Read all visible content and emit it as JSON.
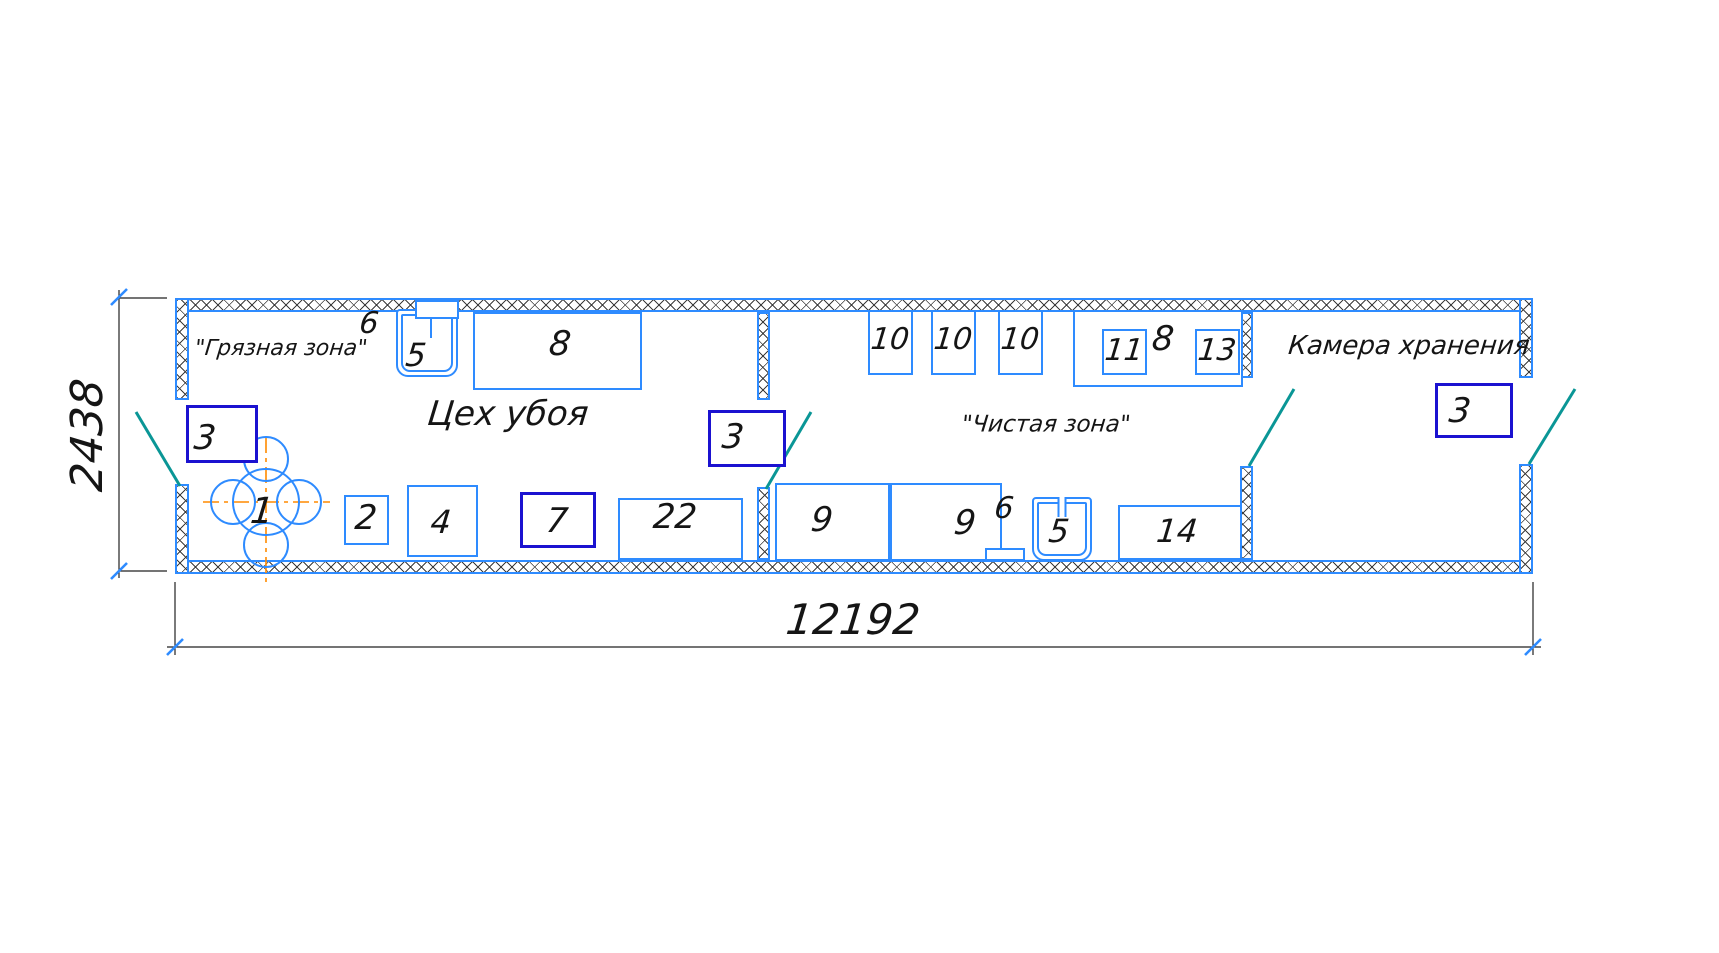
{
  "drawing": {
    "type": "floor-plan",
    "overall_dimensions": {
      "width_mm": "12192",
      "height_mm": "2438"
    },
    "rooms": [
      {
        "name": "Цех убоя",
        "zone_label": "\"Грязная зона\""
      },
      {
        "name": "",
        "zone_label": "\"Чистая зона\""
      },
      {
        "name": "Камера хранения",
        "zone_label": ""
      }
    ],
    "colors": {
      "wall_blue": "#2e8bff",
      "equipment_blue": "#2e8bff",
      "equipment_dark_blue": "#1b12d0",
      "door_teal": "#0a9696",
      "centerline_orange": "#ff8a00",
      "ink": "#151515"
    },
    "walls": [
      {
        "x": 175,
        "y": 298,
        "w": 1358,
        "h": 14,
        "name": "top-outer-wall"
      },
      {
        "x": 175,
        "y": 560,
        "w": 1358,
        "h": 14,
        "name": "bottom-outer-wall"
      },
      {
        "x": 175,
        "y": 298,
        "w": 14,
        "h": 102,
        "name": "left-wall-upper"
      },
      {
        "x": 175,
        "y": 484,
        "w": 14,
        "h": 90,
        "name": "left-wall-lower"
      },
      {
        "x": 1519,
        "y": 298,
        "w": 14,
        "h": 80,
        "name": "right-wall-upper"
      },
      {
        "x": 1519,
        "y": 464,
        "w": 14,
        "h": 110,
        "name": "right-wall-lower"
      },
      {
        "x": 757,
        "y": 312,
        "w": 13,
        "h": 88,
        "name": "partition1-upper"
      },
      {
        "x": 757,
        "y": 487,
        "w": 13,
        "h": 73,
        "name": "partition1-lower"
      },
      {
        "x": 1240,
        "y": 312,
        "w": 13,
        "h": 66,
        "name": "partition2-upper"
      },
      {
        "x": 1240,
        "y": 466,
        "w": 13,
        "h": 94,
        "name": "partition2-lower"
      }
    ],
    "equipment": [
      {
        "label": "3",
        "x": 186,
        "y": 405,
        "w": 72,
        "h": 58,
        "st": "dark"
      },
      {
        "label": "2",
        "x": 344,
        "y": 495,
        "w": 45,
        "h": 50,
        "st": "light"
      },
      {
        "label": "4",
        "x": 407,
        "y": 485,
        "w": 71,
        "h": 72,
        "st": "light"
      },
      {
        "label": "7",
        "x": 520,
        "y": 492,
        "w": 76,
        "h": 56,
        "st": "dark"
      },
      {
        "label": "22",
        "x": 618,
        "y": 498,
        "w": 125,
        "h": 62,
        "st": "light"
      },
      {
        "label": "8",
        "x": 473,
        "y": 312,
        "w": 169,
        "h": 78,
        "st": "light"
      },
      {
        "label": "3",
        "x": 708,
        "y": 410,
        "w": 78,
        "h": 57,
        "st": "dark"
      },
      {
        "label": "10",
        "x": 868,
        "y": 310,
        "w": 45,
        "h": 65,
        "st": "light"
      },
      {
        "label": "10",
        "x": 931,
        "y": 310,
        "w": 45,
        "h": 65,
        "st": "light"
      },
      {
        "label": "10",
        "x": 998,
        "y": 310,
        "w": 45,
        "h": 65,
        "st": "light"
      },
      {
        "label": "8",
        "x": 1073,
        "y": 310,
        "w": 170,
        "h": 77,
        "st": "light"
      },
      {
        "label": "11",
        "x": 1102,
        "y": 329,
        "w": 45,
        "h": 46,
        "st": "light"
      },
      {
        "label": "13",
        "x": 1195,
        "y": 329,
        "w": 45,
        "h": 46,
        "st": "light"
      },
      {
        "label": "9",
        "x": 775,
        "y": 483,
        "w": 115,
        "h": 78,
        "st": "light"
      },
      {
        "label": "9",
        "x": 890,
        "y": 483,
        "w": 112,
        "h": 78,
        "st": "light"
      },
      {
        "label": "",
        "x": 985,
        "y": 548,
        "w": 40,
        "h": 13,
        "st": "light"
      },
      {
        "label": "14",
        "x": 1118,
        "y": 505,
        "w": 124,
        "h": 55,
        "st": "light"
      },
      {
        "label": "3",
        "x": 1435,
        "y": 383,
        "w": 78,
        "h": 55,
        "st": "dark"
      }
    ],
    "sinks": [
      {
        "x": 396,
        "y": 309,
        "w": 62,
        "h": 68,
        "heater": {
          "x": 415,
          "y": 300,
          "w": 44,
          "h": 19
        },
        "pipe": {
          "x": 430,
          "y": 318,
          "h": 20
        }
      },
      {
        "x": 1032,
        "y": 497,
        "w": 60,
        "h": 64,
        "slot": true
      }
    ],
    "scalder_circles": {
      "circles": [
        [
          266,
          502,
          33
        ],
        [
          266,
          459,
          22
        ],
        [
          266,
          545,
          22
        ],
        [
          233,
          502,
          22
        ],
        [
          299,
          502,
          22
        ]
      ],
      "centerlines": [
        [
          266,
          437,
          266,
          585
        ],
        [
          203,
          502,
          330,
          502
        ]
      ]
    },
    "equipment4_ellipse": [
      441,
      521,
      29,
      27
    ],
    "doors": [
      [
        136,
        412,
        180,
        486
      ],
      [
        811,
        412,
        766,
        489
      ],
      [
        1294,
        389,
        1249,
        466
      ],
      [
        1575,
        389,
        1529,
        464
      ]
    ],
    "dim_v": {
      "value": "2438",
      "line": [
        119,
        290,
        119,
        578
      ],
      "ext": [
        [
          119,
          298,
          167,
          298
        ],
        [
          119,
          571,
          167,
          571
        ]
      ],
      "ticks": [
        [
          119,
          297
        ],
        [
          119,
          571
        ]
      ]
    },
    "dim_h": {
      "value": "12192",
      "line": [
        167,
        647,
        1541,
        647
      ],
      "ext": [
        [
          175,
          582,
          175,
          655
        ],
        [
          1533,
          582,
          1533,
          655
        ]
      ],
      "ticks": [
        [
          175,
          647
        ],
        [
          1533,
          647
        ]
      ]
    },
    "texts": [
      {
        "s": "6",
        "x": 369,
        "y": 324,
        "fs": 30,
        "name": "equipment-label-6"
      },
      {
        "s": "5",
        "x": 416,
        "y": 355,
        "fs": 32,
        "name": "equipment-label-5"
      },
      {
        "s": "8",
        "x": 560,
        "y": 344,
        "fs": 34,
        "name": "equipment-label-8"
      },
      {
        "s": "\"Грязная зона\"",
        "x": 281,
        "y": 349,
        "fs": 22,
        "name": "zone-label-dirty"
      },
      {
        "s": "Цех убоя",
        "x": 508,
        "y": 414,
        "fs": 34,
        "name": "room-label-slaughter-shop"
      },
      {
        "s": "3",
        "x": 205,
        "y": 438,
        "fs": 34,
        "name": "equipment-label-3"
      },
      {
        "s": "1",
        "x": 262,
        "y": 512,
        "fs": 36,
        "name": "equipment-label-1"
      },
      {
        "s": "2",
        "x": 366,
        "y": 518,
        "fs": 34,
        "name": "equipment-label-2"
      },
      {
        "s": "4",
        "x": 441,
        "y": 522,
        "fs": 32,
        "name": "equipment-label-4"
      },
      {
        "s": "7",
        "x": 557,
        "y": 521,
        "fs": 34,
        "name": "equipment-label-7"
      },
      {
        "s": "22",
        "x": 675,
        "y": 517,
        "fs": 34,
        "name": "equipment-label-22"
      },
      {
        "s": "3",
        "x": 733,
        "y": 437,
        "fs": 34,
        "name": "equipment-label-3"
      },
      {
        "s": "10",
        "x": 890,
        "y": 340,
        "fs": 30,
        "name": "equipment-label-10"
      },
      {
        "s": "10",
        "x": 953,
        "y": 340,
        "fs": 30,
        "name": "equipment-label-10"
      },
      {
        "s": "10",
        "x": 1020,
        "y": 340,
        "fs": 30,
        "name": "equipment-label-10"
      },
      {
        "s": "11",
        "x": 1124,
        "y": 351,
        "fs": 30,
        "name": "equipment-label-11"
      },
      {
        "s": "8",
        "x": 1163,
        "y": 339,
        "fs": 34,
        "name": "equipment-label-8"
      },
      {
        "s": "13",
        "x": 1217,
        "y": 351,
        "fs": 30,
        "name": "equipment-label-13"
      },
      {
        "s": "\"Чистая зона\"",
        "x": 1046,
        "y": 425,
        "fs": 23,
        "name": "zone-label-clean"
      },
      {
        "s": "9",
        "x": 822,
        "y": 520,
        "fs": 34,
        "name": "equipment-label-9"
      },
      {
        "s": "9",
        "x": 965,
        "y": 523,
        "fs": 34,
        "name": "equipment-label-9"
      },
      {
        "s": "6",
        "x": 1004,
        "y": 509,
        "fs": 30,
        "name": "equipment-label-6"
      },
      {
        "s": "5",
        "x": 1059,
        "y": 531,
        "fs": 32,
        "name": "equipment-label-5"
      },
      {
        "s": "14",
        "x": 1177,
        "y": 531,
        "fs": 32,
        "name": "equipment-label-14"
      },
      {
        "s": "Камера хранения",
        "x": 1409,
        "y": 346,
        "fs": 26,
        "name": "room-label-storage-chamber"
      },
      {
        "s": "3",
        "x": 1460,
        "y": 411,
        "fs": 34,
        "name": "equipment-label-3"
      },
      {
        "s": "2438",
        "x": 88,
        "y": 435,
        "fs": 44,
        "rot": true,
        "name": "dimension-height-value"
      },
      {
        "s": "12192",
        "x": 853,
        "y": 620,
        "fs": 42,
        "name": "dimension-width-value"
      }
    ]
  }
}
